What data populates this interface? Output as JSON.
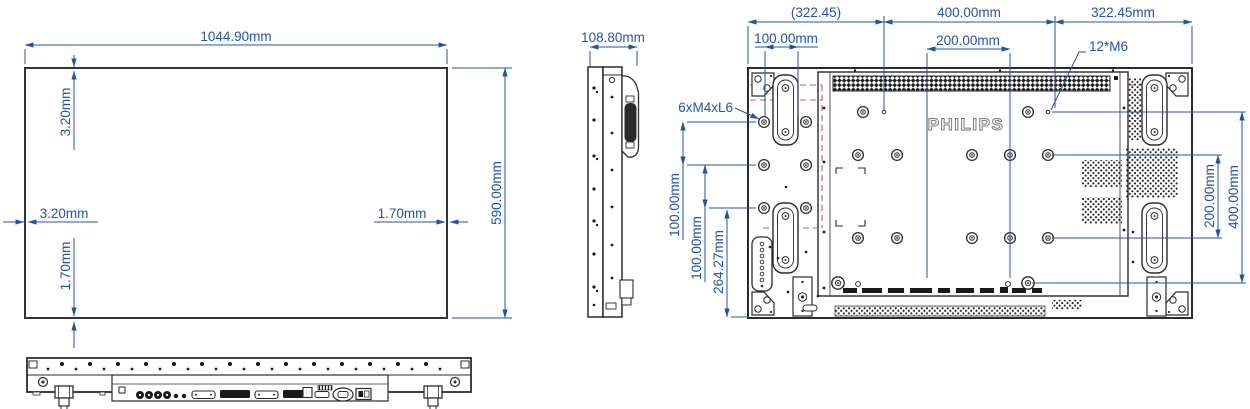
{
  "drawing": {
    "brand": "PHILIPS",
    "front": {
      "width": "1044.90mm",
      "height": "590.00mm",
      "bezel_top": "3.20mm",
      "bezel_left": "3.20mm",
      "bezel_right": "1.70mm",
      "bezel_bottom": "1.70mm"
    },
    "side": {
      "depth": "108.80mm"
    },
    "rear": {
      "top_left_ref": "(322.45)",
      "vesa_width": "400.00mm",
      "top_right": "322.45mm",
      "left_hole_pitch": "100.00mm",
      "vesa_half_width": "200.00mm",
      "m6_screw_spec": "12*M6",
      "m4_screw_spec": "6xM4xL6",
      "left_pitch_v1": "100.00mm",
      "left_pitch_v2": "100.00mm",
      "bottom_offset": "264.27mm",
      "vesa_half_height": "200.00mm",
      "vesa_height": "400.00mm"
    },
    "colors": {
      "dimension_blue": "#2155a4",
      "drawing_line": "#2b2b2b",
      "reference_red": "#e05050",
      "logo_gray": "#7a7a7a"
    }
  }
}
